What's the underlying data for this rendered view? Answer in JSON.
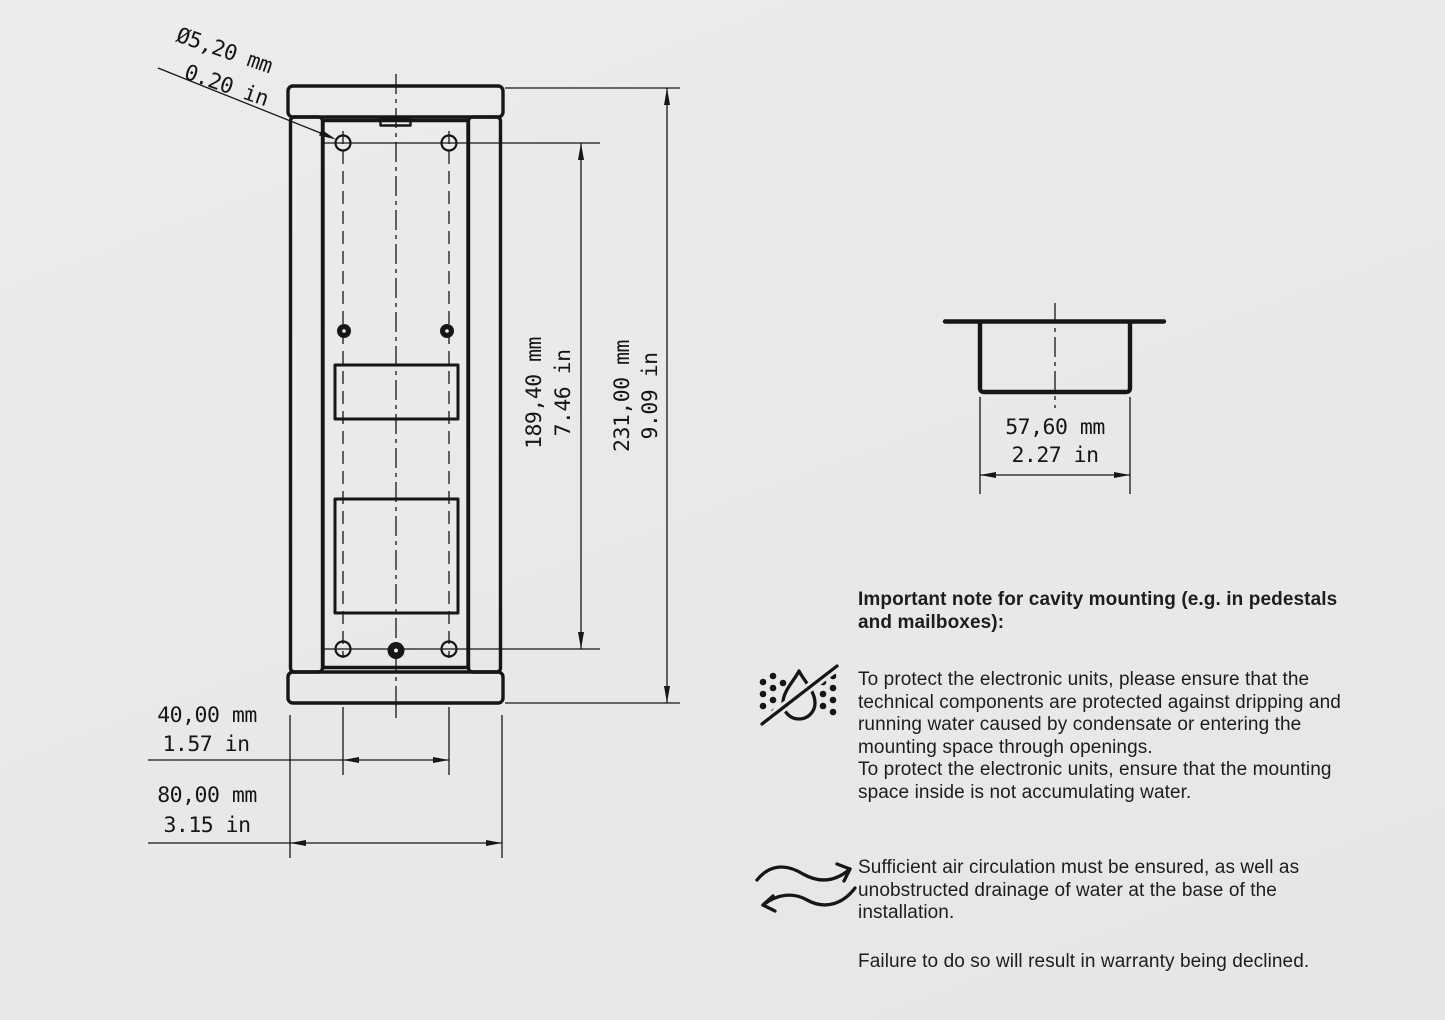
{
  "page": {
    "background": "#e9e9e8",
    "ink_color": "#161616",
    "text_color": "#1d1d1b"
  },
  "drawing": {
    "views": {
      "front_view": "front-elevation-with-mounting-holes",
      "section_view": "top-section-cavity-profile"
    },
    "dims": {
      "hole_dia_mm": "Ø5,20 mm",
      "hole_dia_in": "0.20 in",
      "hole_span_v_mm": "189,40 mm",
      "hole_span_v_in": "7.46 in",
      "total_height_mm": "231,00 mm",
      "total_height_in": "9.09 in",
      "hole_span_h_mm": "40,00 mm",
      "hole_span_h_in": "1.57 in",
      "total_width_mm": "80,00 mm",
      "total_width_in": "3.15 in",
      "cavity_depth_mm": "57,60 mm",
      "cavity_depth_in": "2.27 in"
    }
  },
  "notes": {
    "heading_lines": [
      "Important note for cavity mounting (e.g. in pedestals",
      "and mailboxes):"
    ],
    "water_icon": "no-dripping-water-icon",
    "water_lines": [
      "To protect the electronic units, please ensure that the",
      "technical components are protected against dripping and",
      "running water caused by condensate or entering the",
      "mounting space through openings.",
      "To protect the electronic units, ensure that the mounting",
      "space inside is not accumulating water."
    ],
    "air_icon": "air-circulation-icon",
    "air_lines": [
      "Sufficient air circulation must be ensured, as well as",
      "unobstructed drainage of water at the base of the",
      "installation."
    ],
    "warranty_line": "Failure to do so will result in warranty being declined."
  }
}
